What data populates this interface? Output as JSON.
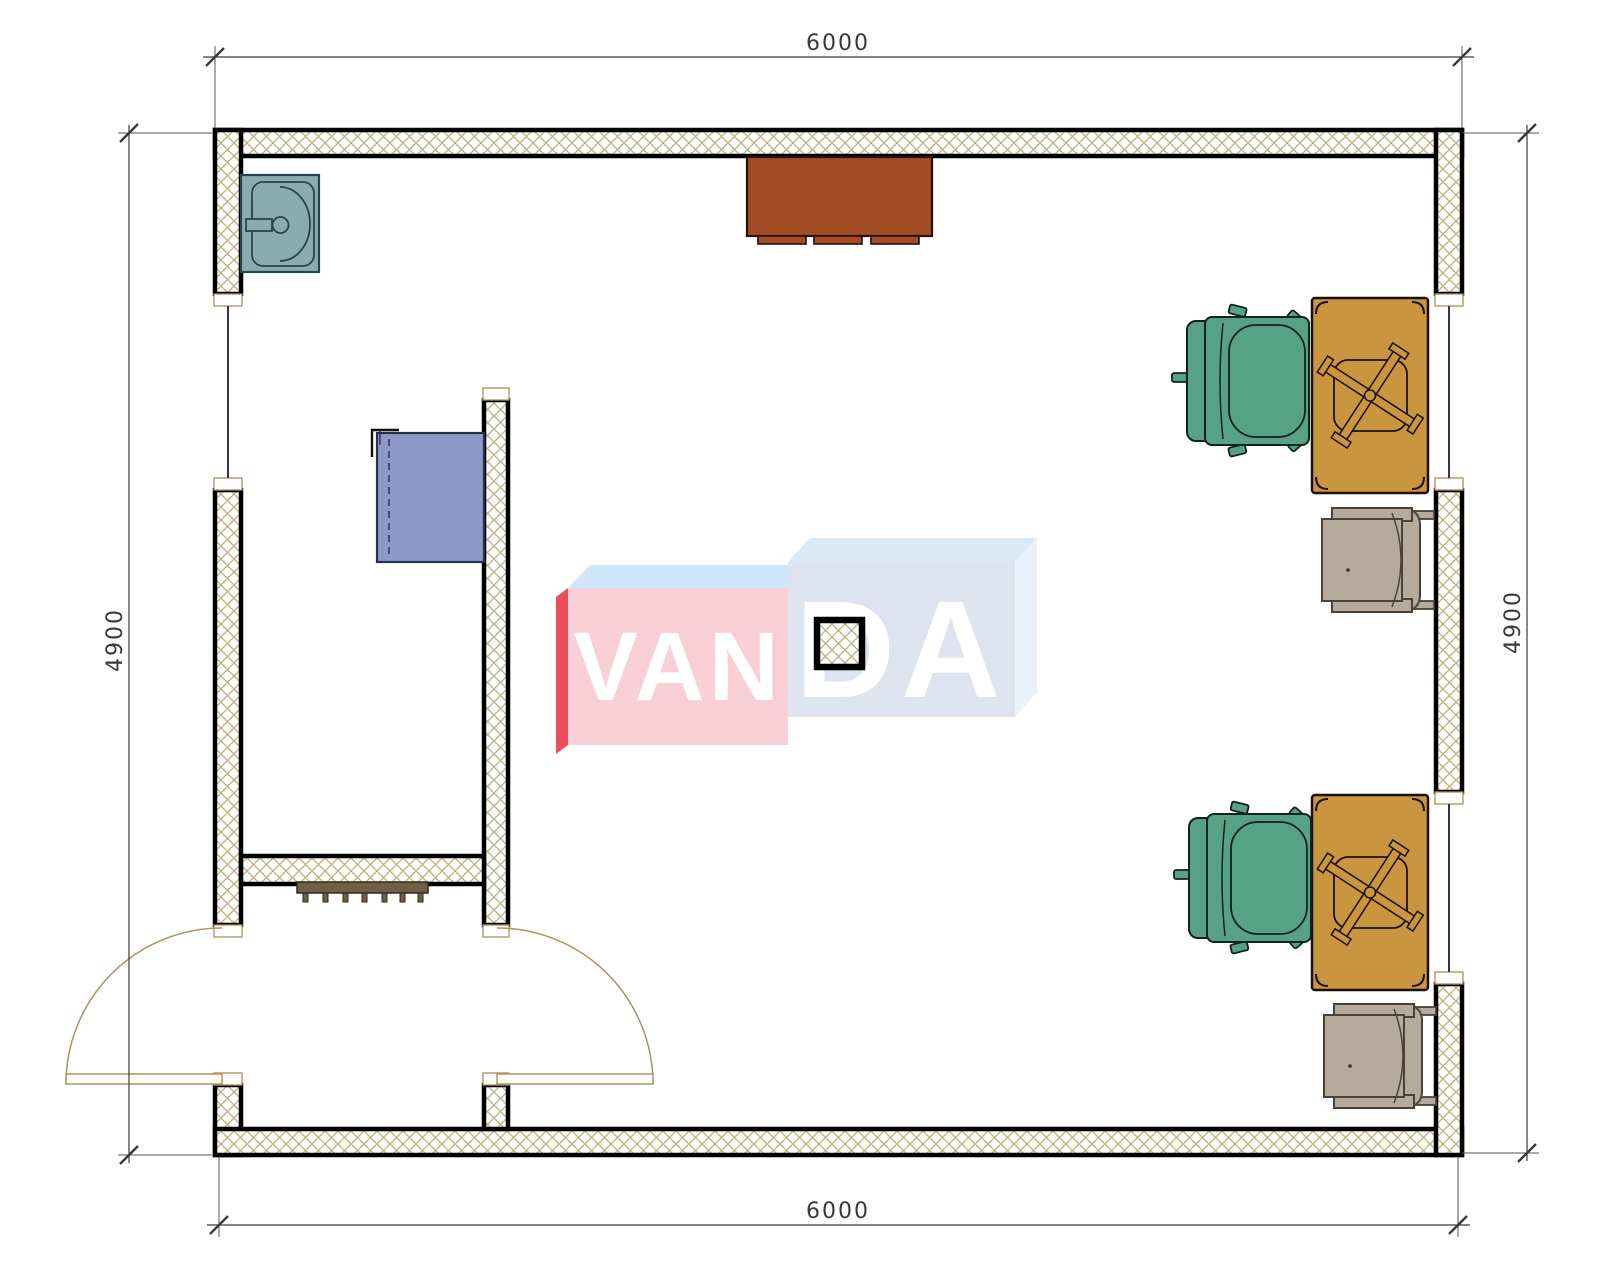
{
  "document": {
    "type": "architectural-floor-plan",
    "background": "#ffffff"
  },
  "dimensions": {
    "top": "6000",
    "bottom": "6000",
    "left": "4900",
    "right": "4900"
  },
  "watermark": {
    "left": "VAN",
    "right": "DA"
  },
  "palette": {
    "wall_outline": "#000000",
    "wall_hatch": "#c2ad7c",
    "cap_stroke": "#b08d57",
    "window": "#2e3550",
    "door": "#b49160",
    "dimension": "#3a3a3a",
    "sink": "#88abb4",
    "top_cabinet": "#a34b24",
    "blue_cabinet": "#8b9ac9",
    "desk": "#c9953e",
    "green_chair": "#57a287",
    "gray_chair": "#b5aa9c",
    "radiator": "#6f6045",
    "logo_pink": "#f9cfd7",
    "logo_red": "#ee4d5c",
    "logo_top_left": "#cfe7f8",
    "logo_top_right": "#d9e9f7",
    "logo_front_right": "#dee4ef",
    "logo_side_right": "#e9f1fa",
    "logo_text": "#ffffff"
  },
  "inventory": {
    "desks": 2,
    "office_chairs": 2,
    "side_chairs": 2,
    "sinks": 1,
    "cabinets": 2,
    "radiators": 1,
    "columns": 1,
    "doors": 2,
    "windows": 3
  }
}
